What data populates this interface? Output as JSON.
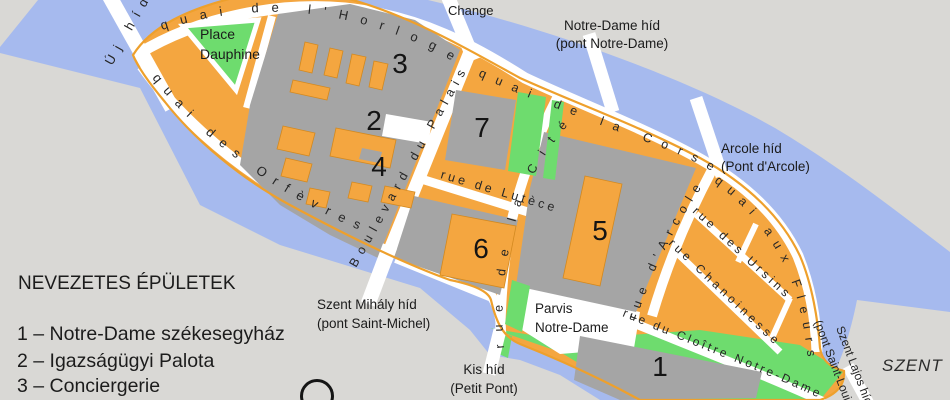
{
  "colors": {
    "water": "#a6baee",
    "land": "#d9d8d5",
    "island": "#f4a640",
    "block": "#a5a5a5",
    "green": "#6edc6e",
    "street": "#ffffff",
    "shore": "#eea02c",
    "ink": "#1b1b1b"
  },
  "legend": {
    "title": "NEVEZETES ÉPÜLETEK",
    "items": [
      "1 – Notre-Dame székesegyház",
      "2 – Igazságügyi Palota",
      "3 – Conciergerie"
    ]
  },
  "labels": {
    "change": "Change",
    "notre_dame_bridge": [
      "Notre-Dame híd",
      "(pont Notre-Dame)"
    ],
    "arcole_bridge": [
      "Arcole híd",
      "(Pont d'Arcole)"
    ],
    "saint_michel_bridge": [
      "Szent Mihály híd",
      "(pont Saint-Michel)"
    ],
    "petit_pont": [
      "Kis híd",
      "(Petit Pont)"
    ],
    "saint_louis_bridge": [
      "Szent Lajos híd",
      "(pont Saint-Louis)"
    ],
    "uj_hid": "Új híd",
    "place_dauphine": [
      "Place",
      "Dauphine"
    ],
    "parvis": [
      "Parvis",
      "Notre-Dame"
    ],
    "szent": "SZENT"
  },
  "streets": {
    "horloge": "quai de l'Horloge",
    "orfevres": "quai des Orfèvres",
    "corse": "quai de la Corse",
    "fleurs": "quai aux Fleurs",
    "palais": "Boulevard du Palais",
    "lutece": "rue de Lutèce",
    "cite": "rue de la Cité",
    "arcole": "rue d'Arcole",
    "ursins": "rue des Ursins",
    "chanoinesse": "rue Chanoinesse",
    "cloitre": "rue du Cloître Notre-Dame"
  },
  "markers": {
    "b1": "1",
    "b2": "2",
    "b3": "3",
    "b4": "4",
    "b5": "5",
    "b6": "6",
    "b7": "7"
  }
}
